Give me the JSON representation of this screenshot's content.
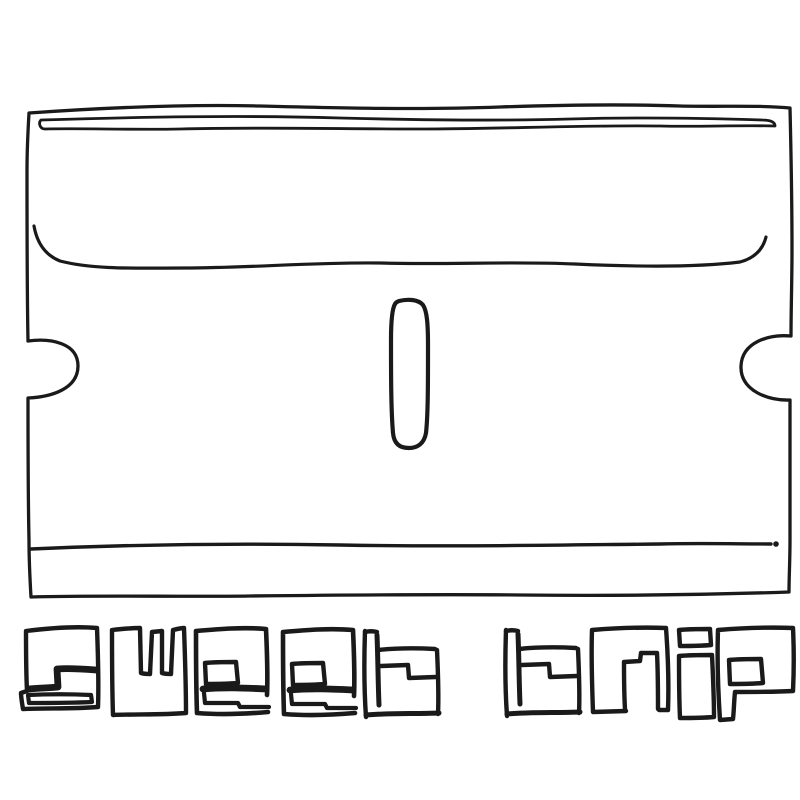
{
  "artwork": {
    "album_title": "sweet trip",
    "illustration": "hand-drawn-razor-blade",
    "colors": {
      "ink": "#1a1a1a",
      "bg": "#ffffff"
    }
  }
}
